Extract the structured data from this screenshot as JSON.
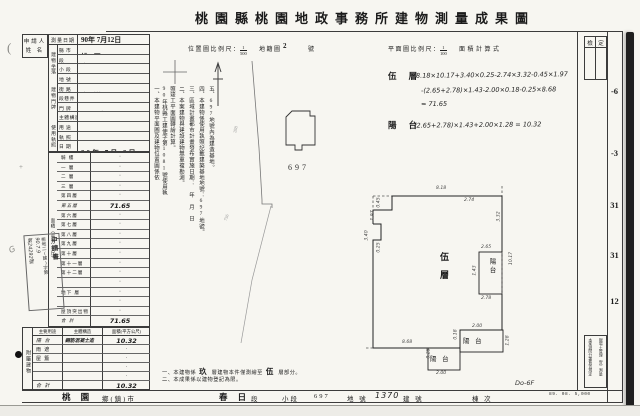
{
  "title": "桃園縣桃園地政事務所建物測量成果圖",
  "scale_bar": {
    "loc_label": "位置圖比例尺：",
    "loc_num": "1",
    "loc_den": "500",
    "cad_label": "地籍圖",
    "cad_no": "2",
    "cad_unit": "號",
    "plan_label": "平面圖比例尺：",
    "plan_num": "1",
    "plan_den": "100",
    "calc_label": "面積計算式"
  },
  "check_box": {
    "left": "檢",
    "right": "定"
  },
  "margin_numbers": [
    {
      "t": "-6",
      "top": 86
    },
    {
      "t": "-3",
      "top": 148
    },
    {
      "t": "31",
      "top": 200
    },
    {
      "t": "31",
      "top": 250
    },
    {
      "t": "12",
      "top": 296
    }
  ],
  "applicant": {
    "line1": "申請人",
    "line2": "姓 名"
  },
  "left_table": {
    "survey": {
      "label": "測量日期",
      "value": "90年 7月12日"
    },
    "groups": {
      "location": "建物坐落",
      "door": "建物門牌",
      "license": "使用執照"
    },
    "rows": [
      {
        "label": "縣 市",
        "value": "桃 園",
        "unit": ""
      },
      {
        "label": "段",
        "value": "春 日",
        "unit": "段"
      },
      {
        "label": "小 段",
        "value": "",
        "unit": "小段"
      },
      {
        "label": "地 號",
        "value": "697",
        "unit": "地號"
      },
      {
        "label": "街 路",
        "value": "大 豐",
        "unit": "街路"
      },
      {
        "label": "段巷弄",
        "value": "2",
        "unit": "段　巷　弄"
      },
      {
        "label": "門 牌",
        "value": "101號",
        "unit": "5樓之4"
      },
      {
        "label": "主體構造",
        "value": "鋼筋混凝土造",
        "unit": "",
        "cls": "sm"
      },
      {
        "label": "用 途",
        "value": "集合住宅",
        "unit": "",
        "cls": "sm"
      },
      {
        "label": "執 照",
        "value": "桃縣工建使字第",
        "unit": "1081號",
        "cls": "sm"
      },
      {
        "label": "日 期",
        "value": "90年 7月 9日",
        "unit": ""
      }
    ],
    "floors_group": "面積（平方公尺）",
    "floors": [
      {
        "label": "騎 樓",
        "value": "·"
      },
      {
        "label": "一 層",
        "value": "·"
      },
      {
        "label": "二 層",
        "value": "·"
      },
      {
        "label": "三 層",
        "value": "·"
      },
      {
        "label": "第四層",
        "value": "·"
      },
      {
        "label": "第五層",
        "value": "71.65",
        "cls": "hw"
      },
      {
        "label": "第六層",
        "value": "·"
      },
      {
        "label": "第七層",
        "value": "·"
      },
      {
        "label": "第八層",
        "value": "·"
      },
      {
        "label": "第九層",
        "value": "·"
      },
      {
        "label": "第十層",
        "value": "·"
      },
      {
        "label": "第十一層",
        "value": "·"
      },
      {
        "label": "第十二層",
        "value": "·"
      },
      {
        "label": "",
        "value": "·"
      },
      {
        "label": "地下 層",
        "value": "·"
      },
      {
        "label": "",
        "value": "·"
      },
      {
        "label": "屋頂突出物",
        "value": "·"
      },
      {
        "label": "合 計",
        "value": "71.65",
        "cls": "hw"
      }
    ],
    "attached": {
      "group": "附屬建物",
      "headers": [
        "主要用途",
        "主體構造",
        "面積(平方公尺)"
      ],
      "rows": [
        {
          "u": "陽 台",
          "s": "鋼筋混凝土造",
          "a": "10.32",
          "cls": "hw"
        },
        {
          "u": "雨 遮",
          "s": "",
          "a": "·"
        },
        {
          "u": "屋 簷",
          "s": "",
          "a": "·"
        },
        {
          "u": "",
          "s": "",
          "a": "·"
        },
        {
          "u": "",
          "s": "",
          "a": "·"
        },
        {
          "u": "合 計",
          "s": "",
          "a": "10.32",
          "cls": "hw"
        }
      ]
    }
  },
  "stamp": {
    "line1": "申請書",
    "line2": "桃地二(建)字第",
    "line3": "90.7.9",
    "line4": "第24292號"
  },
  "notes_vertical": [
    {
      "t": "一、本建物平面圖及建物位置圖係依",
      "left": 152
    },
    {
      "t": "90年桃縣工建使字第1081號使用執",
      "left": 160
    },
    {
      "t": "照竣工平面圖轉繪計算。",
      "left": 168
    },
    {
      "t": "二、本案建物與建設建物無重複勘測。",
      "left": 177
    },
    {
      "t": "三、區域計畫都市計畫發布實施日期：　年　月　日",
      "left": 187
    },
    {
      "t": "四、本建物係使用執照記載建築基地地號：697地號。",
      "left": 197
    },
    {
      "t": "五、697地號內為建造基地。",
      "left": 207
    }
  ],
  "map": {
    "parcel": "697",
    "labels": [
      {
        "t": "288",
        "left": 232,
        "top": 127,
        "rot": -75
      },
      {
        "t": "756",
        "left": 223,
        "top": 215,
        "rot": -70
      }
    ]
  },
  "formulas": {
    "f1_label": "伍 層",
    "f1_l1": "8.18×10.17+3.40×0.25-2.74×3.32-0.45×1.97",
    "f1_l2": "-(2.65+2.78)×1.43-2.00×0.18-0.25×8.68",
    "f1_l3": "= 71.65",
    "f2_label": "陽 台",
    "f2_l1": "(2.65+2.78)×1.43+2.00×1.28 = 10.32"
  },
  "plan": {
    "labels": [
      {
        "t": "伍層",
        "left": 438,
        "top": 252,
        "cls": "floor"
      },
      {
        "t": "陽台",
        "left": 486,
        "top": 258,
        "cls": "balv"
      },
      {
        "t": "陽 台",
        "left": 463,
        "top": 335,
        "cls": "balh"
      },
      {
        "t": "陽 台",
        "left": 430,
        "top": 353,
        "cls": "balh"
      }
    ],
    "dims": [
      {
        "t": "8.18",
        "left": 436,
        "top": 186
      },
      {
        "t": "0.45",
        "left": 374,
        "top": 200,
        "rot": -90
      },
      {
        "t": "1.97",
        "left": 368,
        "top": 213,
        "rot": -90
      },
      {
        "t": "3.40",
        "left": 362,
        "top": 233,
        "rot": -90
      },
      {
        "t": "0.25",
        "left": 374,
        "top": 245,
        "rot": -90
      },
      {
        "t": "2.74",
        "left": 464,
        "top": 198
      },
      {
        "t": "3.32",
        "left": 494,
        "top": 214,
        "rot": -90
      },
      {
        "t": "10.17",
        "left": 505,
        "top": 256,
        "rot": -90
      },
      {
        "t": "2.65",
        "left": 481,
        "top": 245
      },
      {
        "t": "1.43",
        "left": 470,
        "top": 268,
        "rot": -90
      },
      {
        "t": "2.78",
        "left": 481,
        "top": 296
      },
      {
        "t": "2.00",
        "left": 472,
        "top": 324
      },
      {
        "t": "0.18",
        "left": 451,
        "top": 332,
        "rot": -90
      },
      {
        "t": "1.28",
        "left": 503,
        "top": 338,
        "rot": -90
      },
      {
        "t": "8.68",
        "left": 402,
        "top": 340
      },
      {
        "t": "0.25",
        "left": 424,
        "top": 351,
        "rot": -90
      },
      {
        "t": "2.00",
        "left": 436,
        "top": 371
      }
    ]
  },
  "bottom_notes": {
    "n1_pre": "一、本建物係",
    "n1_big1": "玖",
    "n1_mid": "層建物本件僅測繪至",
    "n1_big2": "伍",
    "n1_post": "層部分。",
    "n2": "二、本成果係以建物登記為限。"
  },
  "bottom_strip": {
    "cells": [
      {
        "t": "桃 園",
        "left": 40,
        "cls": "b"
      },
      {
        "t": "鄉(鎮)市",
        "left": 80
      },
      {
        "t": "春 日",
        "left": 197,
        "cls": "b"
      },
      {
        "t": "段",
        "left": 229
      },
      {
        "t": "小段",
        "left": 260
      },
      {
        "t": "697",
        "left": 292
      },
      {
        "t": "地 號",
        "left": 325
      },
      {
        "t": "1370",
        "left": 353,
        "cls": "hw"
      },
      {
        "t": "建 號",
        "left": 381
      },
      {
        "t": "棟 次",
        "left": 450
      }
    ]
  },
  "annotations": {
    "building_no_hw": "Do-6F"
  },
  "right_note_box": {
    "col_right": "現場土管理（宜）測量",
    "col_left": "本案測問分署負責規定"
  },
  "print_code": "89. 08. 5,000"
}
